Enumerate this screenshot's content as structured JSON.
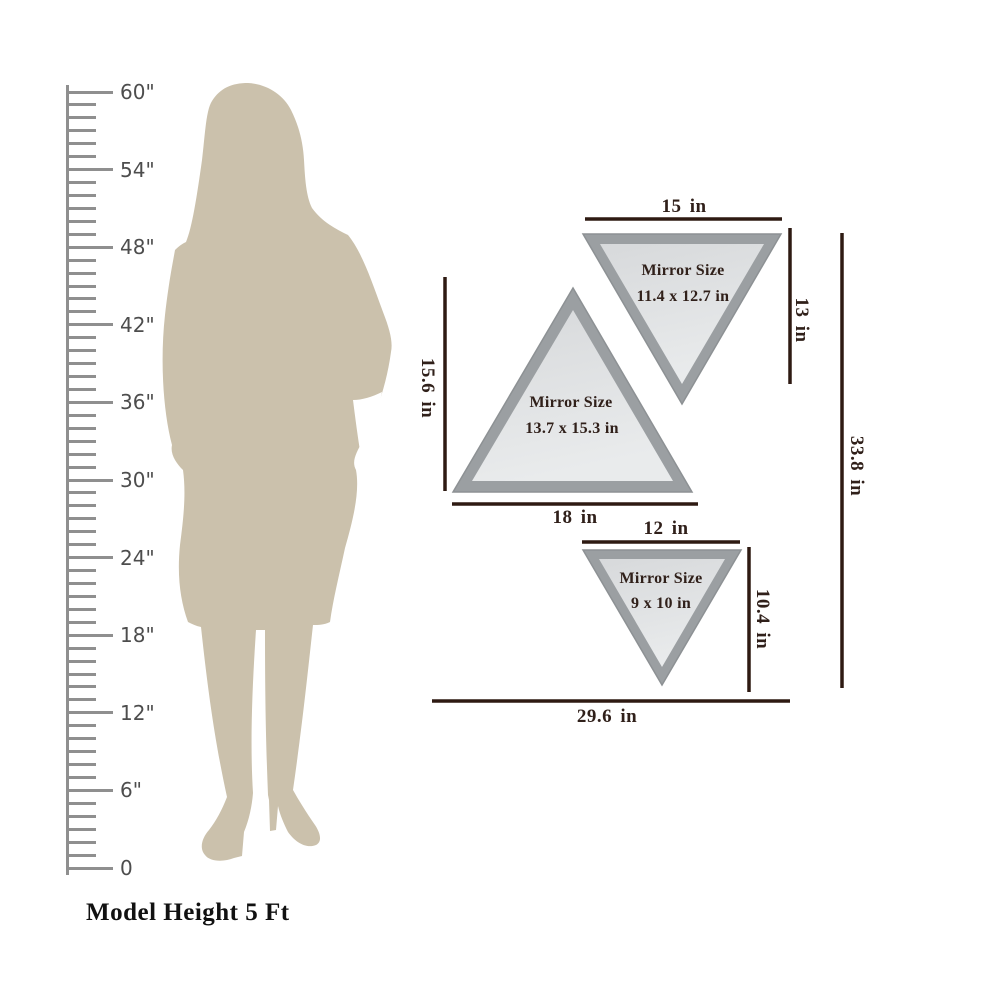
{
  "ruler": {
    "unit_labels": [
      "60\"",
      "54\"",
      "48\"",
      "42\"",
      "36\"",
      "30\"",
      "24\"",
      "18\"",
      "12\"",
      "6\"",
      "0"
    ],
    "caption": "Model Height 5 Ft"
  },
  "mirrors": {
    "medium": {
      "title": "Mirror Size",
      "size": "11.4 x 12.7 in",
      "width": "15 in",
      "height": "13 in"
    },
    "large": {
      "title": "Mirror Size",
      "size": "13.7 x 15.3 in",
      "width": "18 in",
      "height": "15.6 in"
    },
    "small": {
      "title": "Mirror Size",
      "size": "9 x 10 in",
      "width": "12 in",
      "height": "10.4 in"
    },
    "overall": {
      "width": "29.6 in",
      "height": "33.8 in"
    }
  },
  "colors": {
    "silhouette": "#cbc1ac",
    "ruler": "#8f8f8f",
    "ruler_text": "#4d4d4d",
    "dimension": "#2e1a12",
    "frame": "#9b9fa2",
    "mirror_light": "#e9ebec",
    "mirror_dark": "#d7d9db",
    "label_text": "#30201a"
  }
}
